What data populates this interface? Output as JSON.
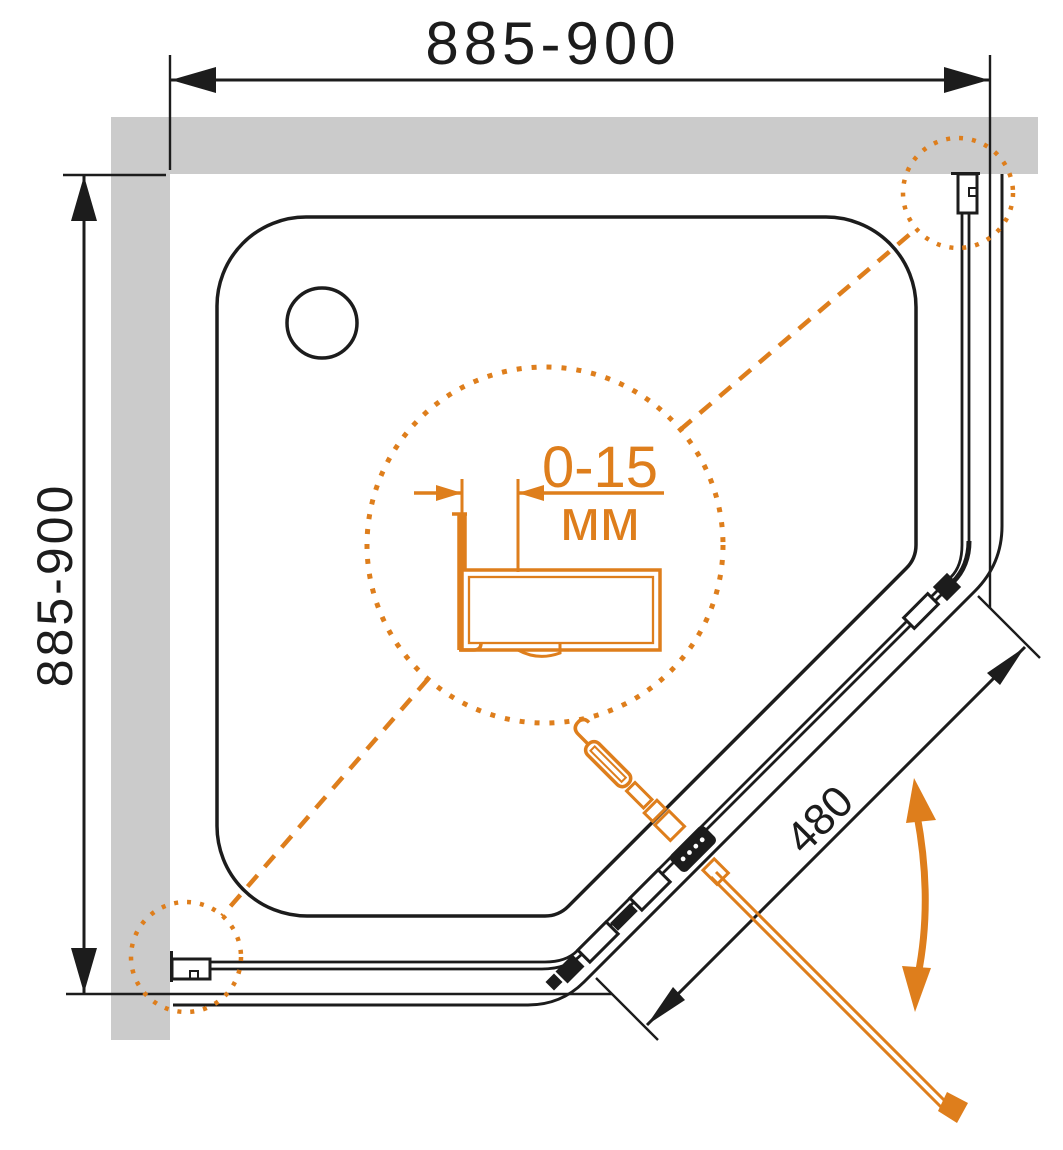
{
  "diagram": {
    "type": "shower-enclosure-plan-view",
    "dim_top": "885-900",
    "dim_left": "885-900",
    "dim_door": "480",
    "detail_value": "0-15",
    "detail_unit": "мм",
    "colors": {
      "accent": "#de7e1c",
      "wall": "#cbcbcb",
      "line": "#1c1c1c",
      "background": "#ffffff"
    }
  }
}
